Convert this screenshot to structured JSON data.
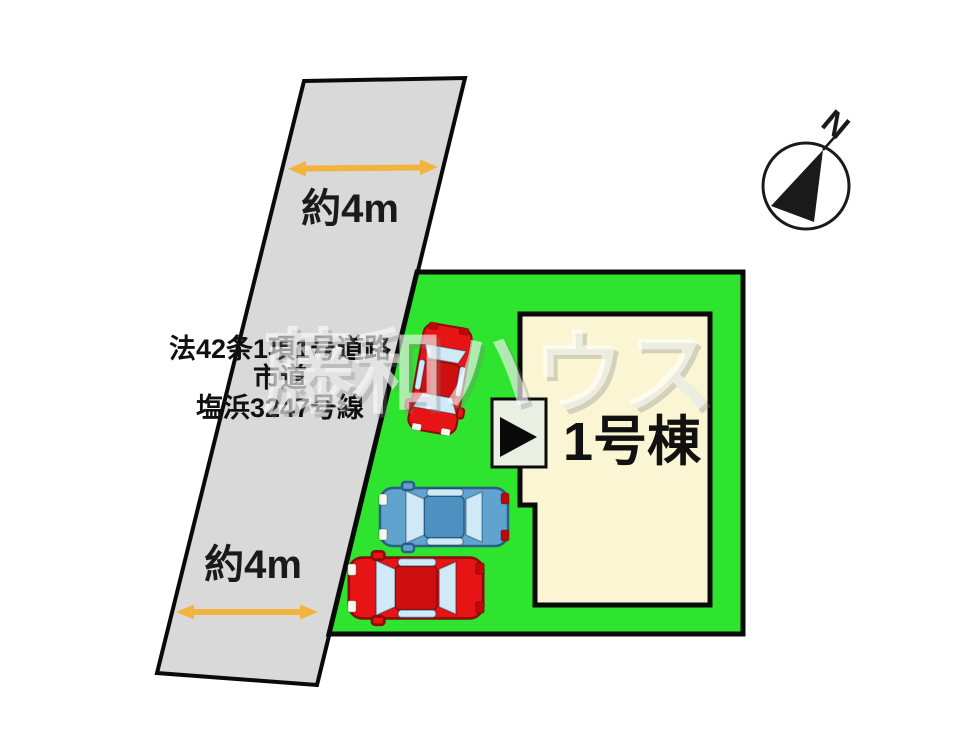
{
  "diagram": {
    "road": {
      "width_label_top": "約4m",
      "width_label_bottom": "約4m",
      "name_lines": [
        "法42条1項1号道路",
        "市道",
        "塩浜3247号線"
      ]
    },
    "plot": {
      "building_label": "1号棟"
    },
    "compass": {
      "north_label": "N"
    },
    "watermark_text": "藤和ハウス",
    "colors": {
      "road_fill": "#d9d9d9",
      "plot_green": "#2fe42f",
      "building_fill": "#faf5d2",
      "entrance_fill": "#eaeee3",
      "arrow_orange": "#f2b43c",
      "car_red": "#e61414",
      "car_red_roof": "#cd0f0f",
      "car_red_outline": "#8e0b0b",
      "car_blue": "#5fa3ce",
      "car_blue_roof": "#4c91bf",
      "car_blue_outline": "#2a5f88",
      "car_window": "#cfe9f7"
    }
  }
}
